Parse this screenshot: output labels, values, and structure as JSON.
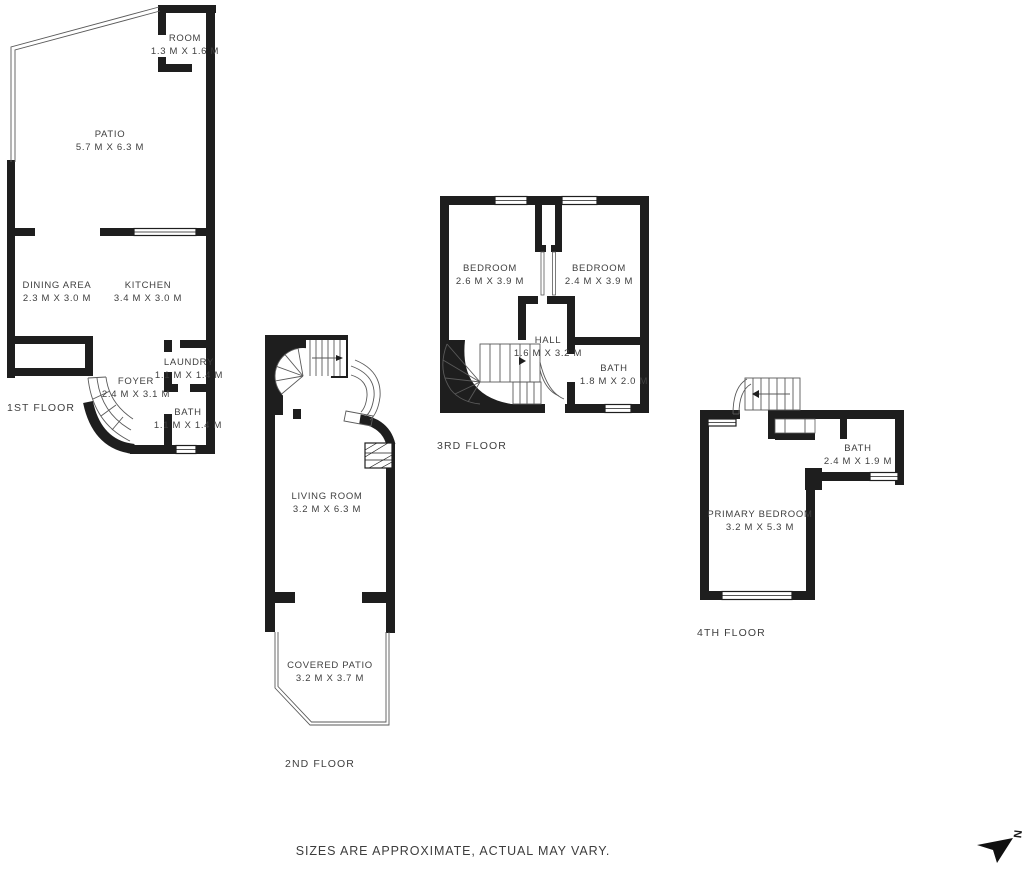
{
  "floors": [
    {
      "label": "1ST FLOOR",
      "rooms": [
        {
          "name": "ROOM",
          "dims": "1.3 M X 1.6 M"
        },
        {
          "name": "PATIO",
          "dims": "5.7 M X 6.3 M"
        },
        {
          "name": "DINING AREA",
          "dims": "2.3 M X 3.0 M"
        },
        {
          "name": "KITCHEN",
          "dims": "3.4 M X 3.0 M"
        },
        {
          "name": "LAUNDRY",
          "dims": "1.1 M X 1.4 M"
        },
        {
          "name": "FOYER",
          "dims": "2.4 M X 3.1 M"
        },
        {
          "name": "BATH",
          "dims": "1.1 M X 1.4 M"
        }
      ]
    },
    {
      "label": "2ND FLOOR",
      "rooms": [
        {
          "name": "LIVING ROOM",
          "dims": "3.2 M X 6.3 M"
        },
        {
          "name": "COVERED PATIO",
          "dims": "3.2 M X 3.7 M"
        }
      ]
    },
    {
      "label": "3RD FLOOR",
      "rooms": [
        {
          "name": "BEDROOM",
          "dims": "2.6 M X 3.9 M"
        },
        {
          "name": "BEDROOM",
          "dims": "2.4 M X 3.9 M"
        },
        {
          "name": "HALL",
          "dims": "1.6 M X 3.2 M"
        },
        {
          "name": "BATH",
          "dims": "1.8 M X 2.0 M"
        }
      ]
    },
    {
      "label": "4TH FLOOR",
      "rooms": [
        {
          "name": "PRIMARY BEDROOM",
          "dims": "3.2 M X 5.3 M"
        },
        {
          "name": "BATH",
          "dims": "2.4 M X 1.9 M"
        }
      ]
    }
  ],
  "footer": {
    "disclaimer": "SIZES ARE APPROXIMATE, ACTUAL MAY VARY."
  },
  "compass": {
    "north_label": "N"
  },
  "colors": {
    "wall": "#1e1e1e",
    "text": "#3f3f3f"
  }
}
